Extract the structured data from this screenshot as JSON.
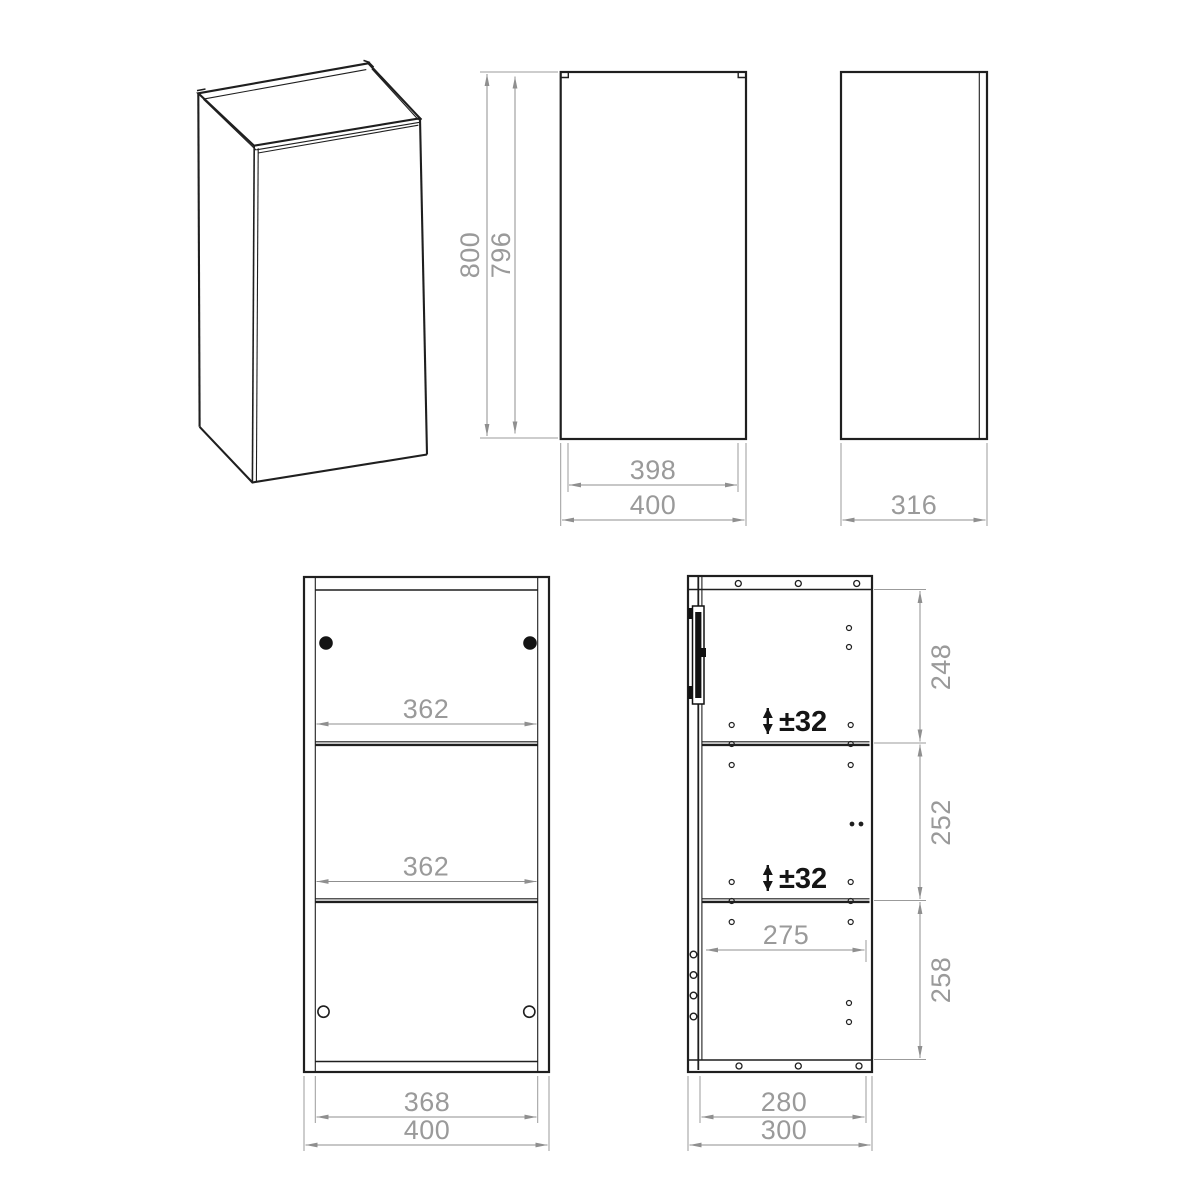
{
  "drawing": {
    "background": "#ffffff",
    "colors": {
      "object_line": "#1f1f1f",
      "dimension_line": "#8f8f8f",
      "dimension_text": "#9a9a9a",
      "annotation_text": "#151515"
    },
    "views": {
      "front": {
        "dims": {
          "overall_height": "800",
          "door_height": "796",
          "door_width": "398",
          "overall_width": "400"
        }
      },
      "side": {
        "dims": {
          "overall_depth": "316"
        }
      },
      "interior_front": {
        "dims": {
          "upper_shelf_width": "362",
          "lower_shelf_width": "362",
          "inner_width": "368",
          "overall_width": "400"
        }
      },
      "section_side": {
        "dims": {
          "upper_bay_height": "248",
          "middle_bay_height": "252",
          "lower_bay_height": "258",
          "upper_shelf_adjust": "±32",
          "lower_shelf_adjust": "±32",
          "shelf_depth": "275",
          "inner_depth": "280",
          "overall_depth": "300"
        }
      }
    }
  }
}
